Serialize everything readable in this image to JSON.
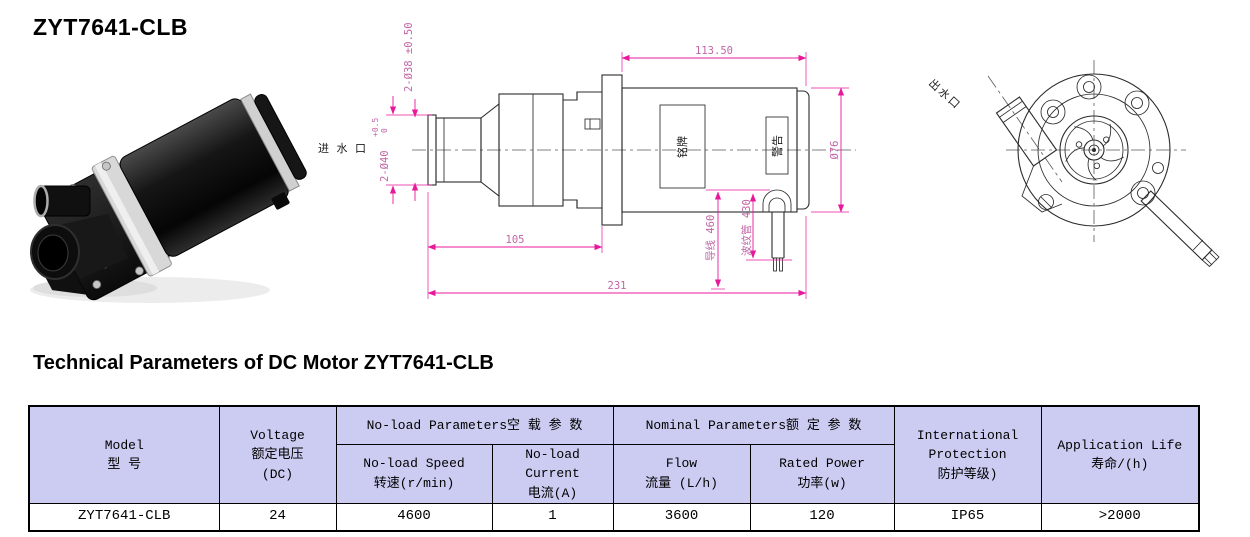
{
  "page": {
    "title": "ZYT7641-CLB",
    "section_heading": "Technical Parameters of DC Motor ZYT7641-CLB"
  },
  "colors": {
    "table_header_bg": "#ccccf2",
    "dimension_line": "#e8189b",
    "dimension_text": "#c265a6",
    "drawing_line": "#2b2b2b"
  },
  "drawing_side": {
    "dim_port_38": "2-Ø38 ±0.50",
    "dim_port_40": "2-Ø40",
    "dim_port_40_tol_upper": "+0.5",
    "dim_port_40_tol_lower": "0",
    "inlet_label": "进 水 口",
    "dim_motor_length": "113.50",
    "dim_motor_diameter": "Ø76",
    "dim_pump_length": "105",
    "dim_total_length": "231",
    "dim_lead_wire": "导线 460",
    "dim_corrugated_tube": "波纹管 430",
    "nameplate_label": "铭牌",
    "warning_label": "警告"
  },
  "drawing_front": {
    "outlet_label": "出水口"
  },
  "table": {
    "headers": {
      "model": [
        "Model",
        "型 号"
      ],
      "voltage": [
        "Voltage",
        "额定电压",
        "(DC)"
      ],
      "noload_group": "No-load Parameters空 载 参 数",
      "noload_speed": [
        "No-load Speed",
        "转速(r/min)"
      ],
      "noload_current": [
        "No-load Current",
        "电流(A)"
      ],
      "nominal_group": "Nominal Parameters额  定  参  数",
      "flow": [
        "Flow",
        "流量 (L/h)"
      ],
      "rated_power": [
        "Rated Power",
        "功率(w)"
      ],
      "protection": [
        "International",
        "Protection",
        "防护等级)"
      ],
      "life": [
        "Application Life",
        "寿命/(h)"
      ]
    },
    "row": {
      "model": "ZYT7641-CLB",
      "voltage": "24",
      "speed": "4600",
      "current": "1",
      "flow": "3600",
      "power": "120",
      "protection": "IP65",
      "life": ">2000"
    }
  }
}
